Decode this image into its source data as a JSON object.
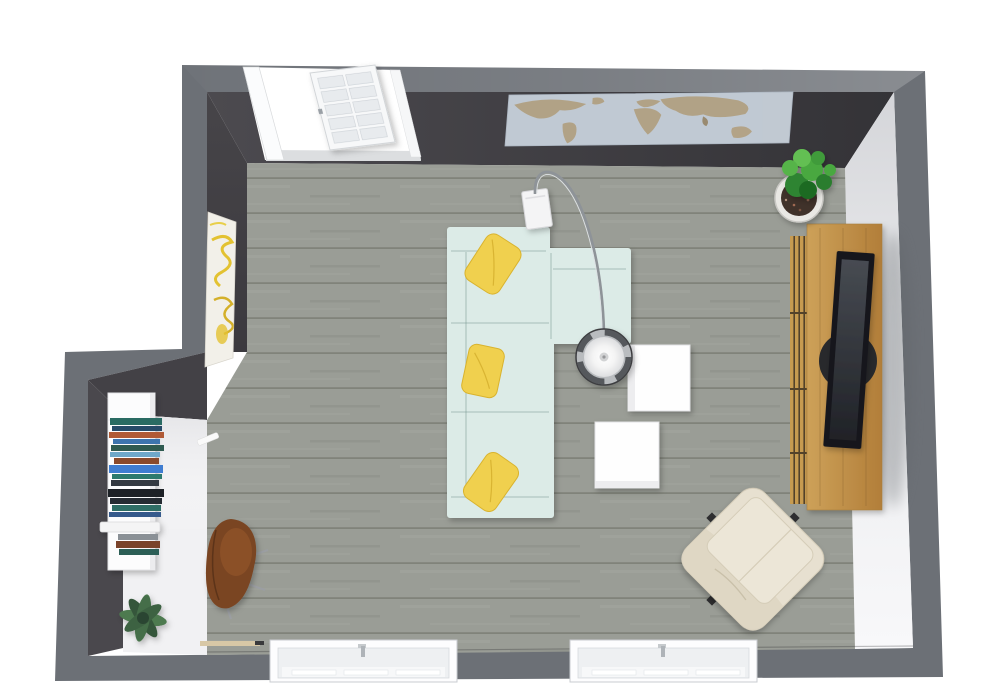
{
  "scene": {
    "view": "floor-plan-top-view",
    "room": "living-room"
  },
  "palette": {
    "background": "#ffffff",
    "wall": "#6c7076",
    "wall_face_dark": "#413f44",
    "wall_face_light": "#e9eaec",
    "floor": "#9a9d96",
    "floor_line": "#7e8178",
    "alcove_floor": "#f1f1f3",
    "sofa": "#dcebe7",
    "sofa_seam": "#9fbcb6",
    "pillow": "#f0d04e",
    "cube_table": "#fefefe",
    "lamp_chrome": "#8e9398",
    "wood": "#c79b50",
    "wood_gap": "#53422a",
    "tv_frame": "#17181a",
    "tv_screen": "#3a3e44",
    "speaker": "#28292c",
    "plant_green_1": "#2f8433",
    "plant_green_2": "#4aa83f",
    "plant_green_3": "#63bf52",
    "plant_sage": "#4d7a50",
    "plant_sage_dark": "#35573a",
    "pot": "#e9e8e4",
    "soil": "#40302a",
    "armchair": "#e7e0d0",
    "chair_brown": "#7a4423",
    "sideboard": "#fcfcfd",
    "map_sea": "#c3ceda",
    "map_land": "#b3a183",
    "door": "#f7f8f9",
    "window_frame": "#fdfdfe",
    "window_inner": "#eef0f2",
    "artwork_canvas": "#f2f0e9",
    "artwork_yellow": "#e3c231",
    "threshold": "#d8c8a6"
  },
  "books": {
    "colors": [
      "#2a6b63",
      "#274a68",
      "#b05a36",
      "#3d74ae",
      "#2f5a50",
      "#6fa8c9",
      "#8a4a2c",
      "#3f7dd1",
      "#2d7a6e",
      "#343a42",
      "#1d2126",
      "#262c33",
      "#2f6e66",
      "#365a8c",
      "#8a9096",
      "#7a432a",
      "#2c5e56"
    ]
  },
  "objects": [
    {
      "id": "sectional-sofa",
      "label": "l-shaped-sectional-sofa"
    },
    {
      "id": "throw-pillow",
      "label": "yellow-throw-pillow"
    },
    {
      "id": "arc-floor-lamp",
      "label": "arc-floor-lamp"
    },
    {
      "id": "side-table-cube",
      "label": "white-cube-side-table"
    },
    {
      "id": "media-console",
      "label": "wood-media-console"
    },
    {
      "id": "tv",
      "label": "flat-screen-tv"
    },
    {
      "id": "potted-plant",
      "label": "potted-plant"
    },
    {
      "id": "accent-armchair",
      "label": "cream-swivel-armchair"
    },
    {
      "id": "lounge-chair-brown",
      "label": "brown-leather-lounge-chair"
    },
    {
      "id": "sideboard",
      "label": "white-sideboard-with-books"
    },
    {
      "id": "floor-plant",
      "label": "sage-floor-plant"
    },
    {
      "id": "world-map-art",
      "label": "world-map-wall-art"
    },
    {
      "id": "wall-artwork",
      "label": "abstract-canvas-art"
    },
    {
      "id": "entry-door",
      "label": "glazed-entry-door"
    },
    {
      "id": "window",
      "label": "window"
    }
  ]
}
